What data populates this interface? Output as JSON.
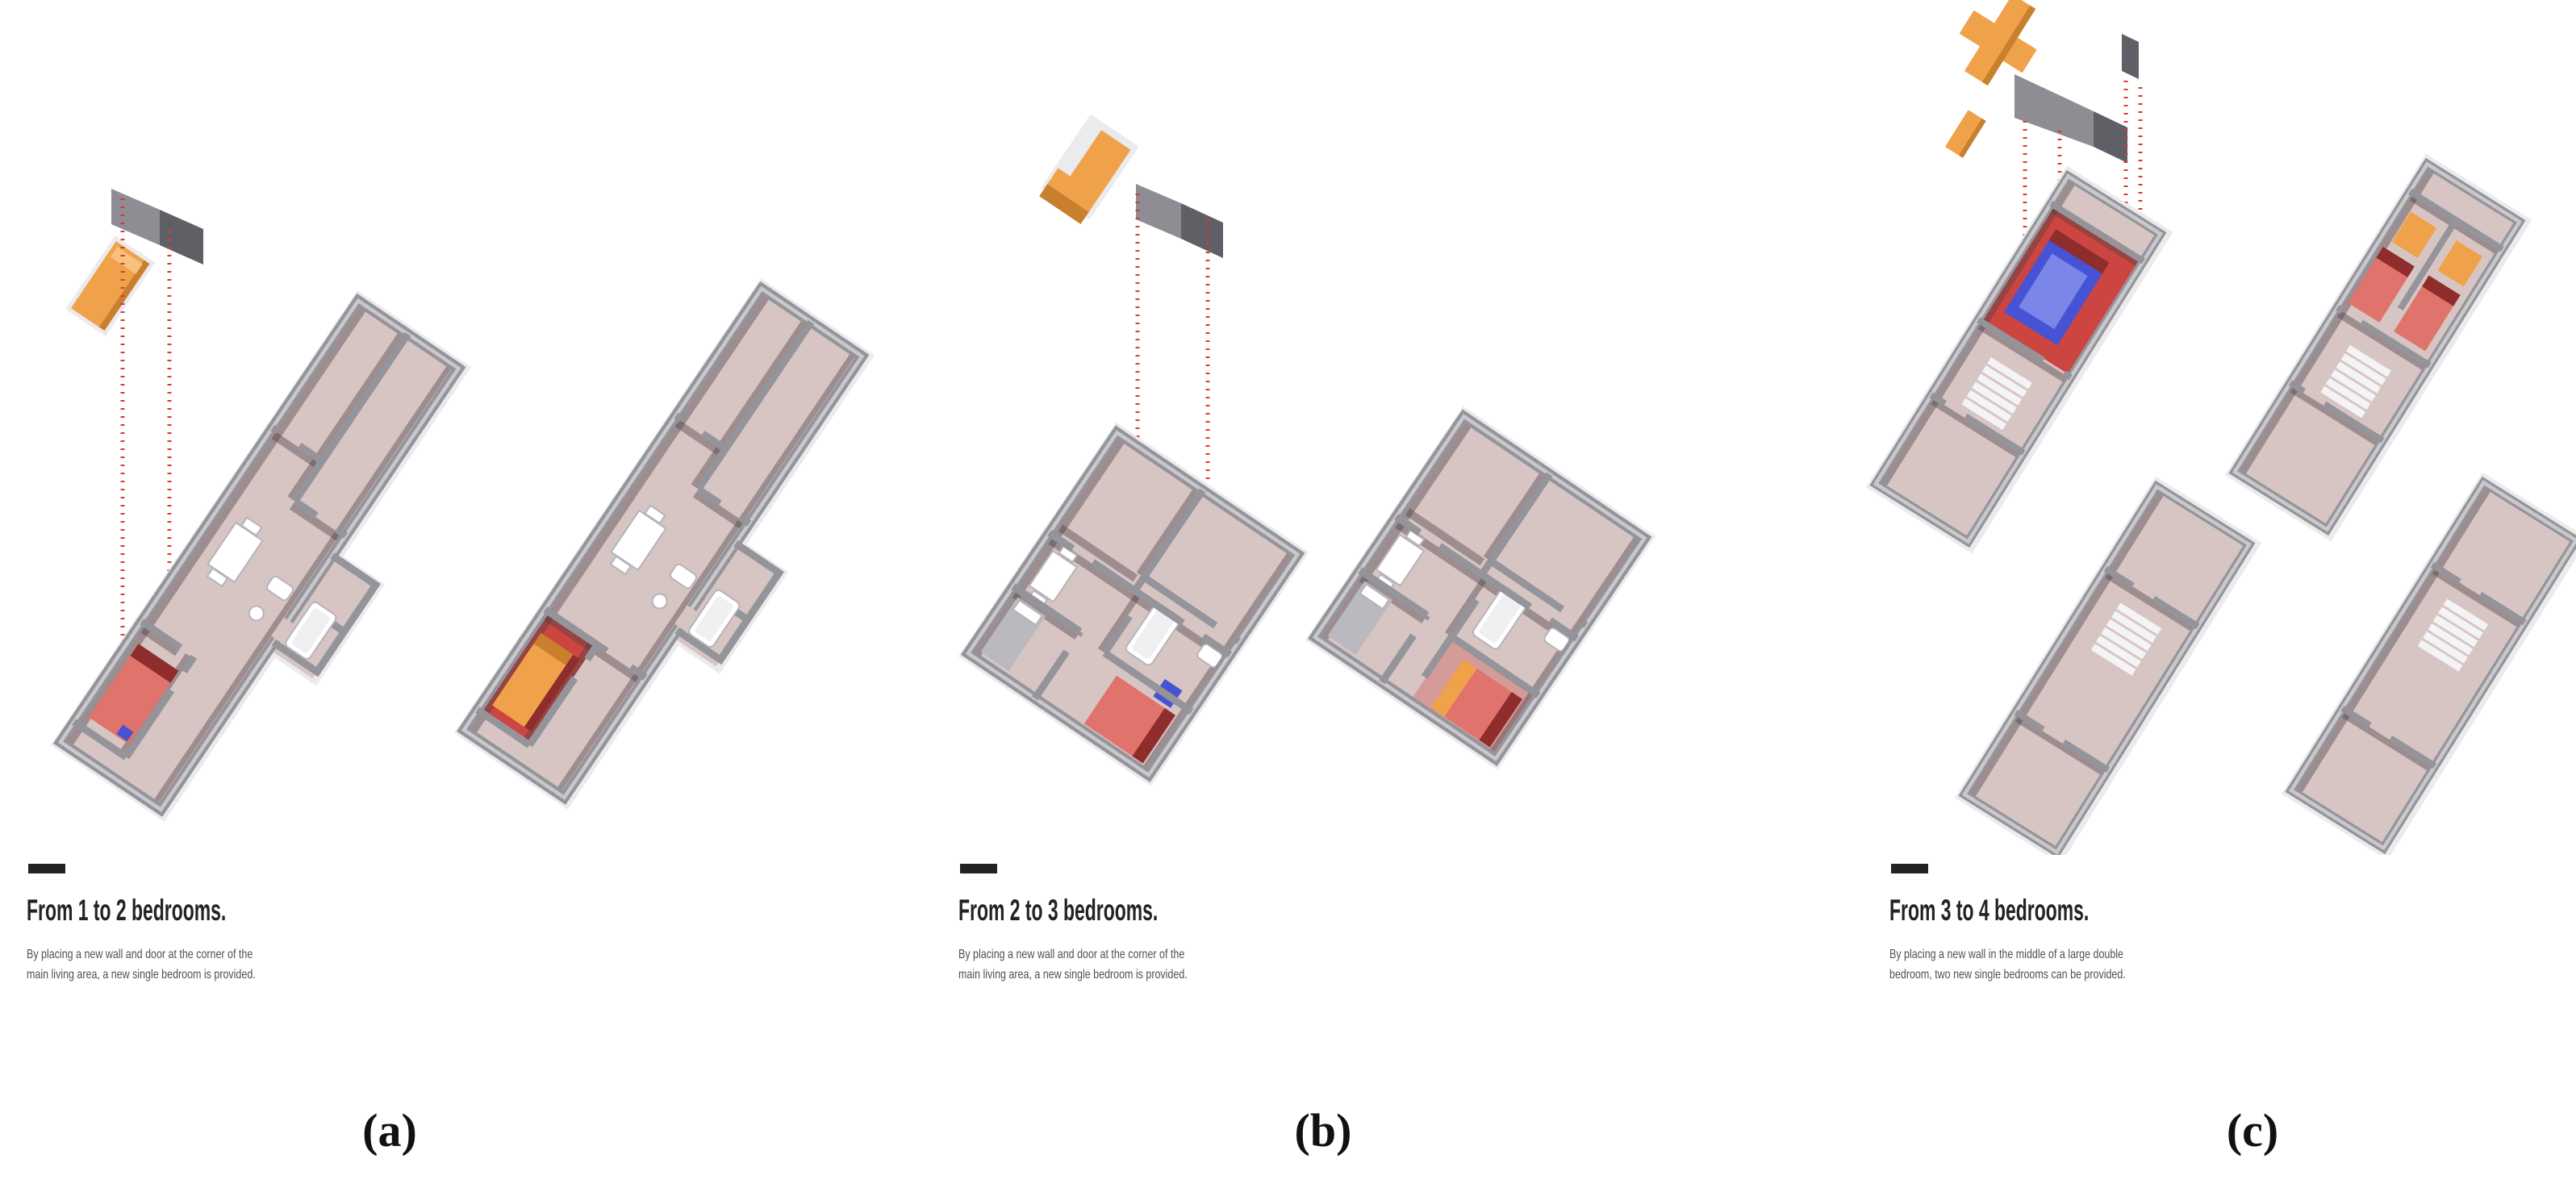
{
  "figure": {
    "panels": [
      {
        "id": "a",
        "label": "(a)",
        "title": "From 1 to 2 bedrooms.",
        "subtitle_line1": "By placing a new wall and door at the corner of the",
        "subtitle_line2": "main living area, a new single bedroom is provided."
      },
      {
        "id": "b",
        "label": "(b)",
        "title": "From 2 to 3 bedrooms.",
        "subtitle_line1": "By placing a new wall and door at the corner of the",
        "subtitle_line2": "main living area, a new single bedroom is provided."
      },
      {
        "id": "c",
        "label": "(c)",
        "title": "From 3 to 4 bedrooms.",
        "subtitle_line1": "By placing a new wall in the middle of a large double",
        "subtitle_line2": "bedroom, two new single bedrooms can be provided."
      }
    ]
  },
  "colors": {
    "page_bg": "#ffffff",
    "floor_pink": "#d7c5c3",
    "floor_red": "#cc4540",
    "wall_grey": "#94949a",
    "wall_light": "#c8c8cd",
    "wall_panel_light": "#8d8d93",
    "wall_panel_dark": "#5f5f66",
    "slab_white": "#ebebee",
    "shadow_dark": "#4d4046",
    "bed_red": "#e0736b",
    "bed_maroon": "#8f2c2c",
    "bed_blue": "#4653d4",
    "bed_blue_light": "#7b86e8",
    "bed_grey": "#b9b9bf",
    "accent_orange": "#f0a24a",
    "accent_orange_dark": "#c87f2e",
    "stair_white": "#f4f4f6",
    "furniture_white": "#ffffff",
    "leader_red": "#d93a32",
    "text_dark": "#232323",
    "text_grey": "#4f5052",
    "label_black": "#111111"
  }
}
